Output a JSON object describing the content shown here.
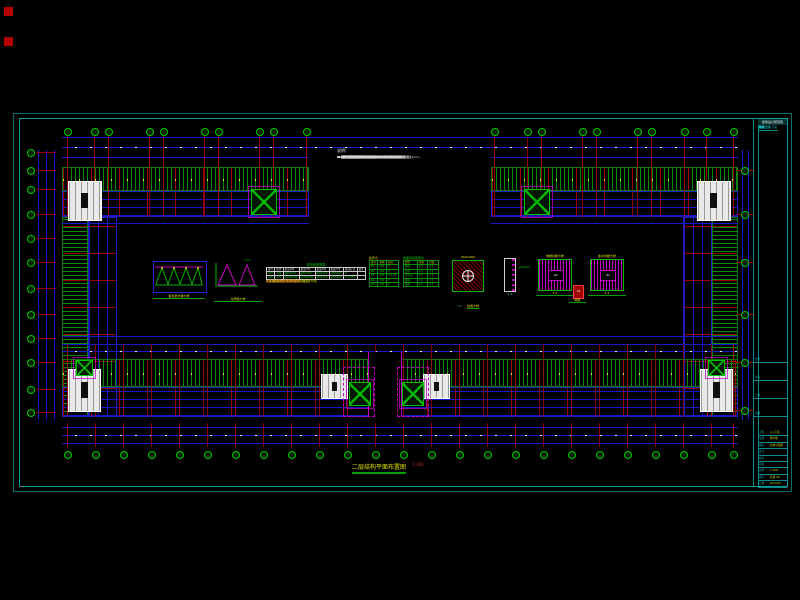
{
  "colors": {
    "bg": "#000000",
    "frame": "#0e9c9c",
    "green": "#00c000",
    "blue": "#1717cf",
    "red": "#b40000",
    "magenta": "#c400c4",
    "yellow": "#e0e000",
    "white": "#e9e9e9",
    "cyan_text": "#18b8b8"
  },
  "notes": {
    "title": "说明:",
    "lines": [
      "1. 本图尺寸除标高以米计外，其余均以毫米计。",
      "2. 本层结构标高为 3.570m。",
      "3. 本层现浇板混凝土强度等级为C30，钢筋保护层厚度15mm。",
      "4. 图中未注明板厚均为100mm。",
      "5. 未注明板底钢筋均为φ8@200，双向布置。",
      "6. 未注明板面负筋均为φ8@200，长度详见平面图。",
      "7. 板内分布筋均为φ6@250。",
      "8. 双向板底筋短跨方向在下，长跨方向在上。",
      "9. 卫生间、阳台板面标高降低50mm，详见建筑图。",
      "10. 板上预留洞口位置及尺寸详见建筑及设备图。",
      "11. 洞口直径或宽度不大于300mm时，钢筋绕洞口通过。",
      "12. 洞口大于300mm时，洞边附加钢筋详见大样图。",
      "13. 板角附加放射筋详见大样。",
      "14. 悬挑板阳角附加放射筋7φ10。",
      "15. 梁配筋详见梁平法施工图。",
      "16. 柱配筋详见柱平法施工图。",
      "17. 楼梯详见楼梯详图。",
      "18. 电梯井道详见大样图。",
      "19. 施工时应与建筑及设备各专业图纸密切配合。",
      "20. 未尽事宜详见结构设计总说明。"
    ]
  },
  "details": {
    "truss_label": "板负筋支撑大样",
    "tri_label": "马凳筋大样",
    "tri_dim": "h-30",
    "rebar_table": {
      "title": "现浇板配筋表",
      "headers": [
        "编号",
        "板厚",
        "板底X向",
        "板底Y向",
        "板面X向",
        "板面Y向",
        "板面标高",
        "备注"
      ],
      "rows": [
        [
          "LB1",
          "100",
          "φ8@200",
          "φ8@200",
          "φ8@200",
          "φ8@200",
          "H",
          ""
        ],
        [
          "LB2",
          "120",
          "φ10@200",
          "φ10@200",
          "φ8@200",
          "φ8@200",
          "H-0.050",
          ""
        ]
      ],
      "notes": [
        "注:1.板配筋图中未注明者详见本表。",
        "2.板底钢筋伸入支座长度≥5d且至梁中线。",
        "3.板面负筋长度自梁边起算。",
        "4.施工时严禁踩踏板面负筋。"
      ]
    },
    "green_table_1": {
      "title": "板厚表",
      "headers": [
        "编号",
        "板厚",
        "标高"
      ],
      "rows": [
        [
          "B1",
          "100",
          "H"
        ],
        [
          "B2",
          "110",
          "H"
        ],
        [
          "B3",
          "120",
          "H-0.05"
        ],
        [
          "B4",
          "130",
          "H"
        ],
        [
          "B5",
          "150",
          "H"
        ]
      ]
    },
    "green_table_2": {
      "title": "楼面荷载取值表",
      "headers": [
        "部位",
        "恒载",
        "活载"
      ],
      "rows": [
        [
          "楼面",
          "4.0",
          "2.0"
        ],
        [
          "走廊",
          "4.0",
          "2.5"
        ],
        [
          "卫生间",
          "4.5",
          "2.5"
        ],
        [
          "楼梯",
          "7.0",
          "3.5"
        ],
        [
          "屋面",
          "5.0",
          "0.5"
        ]
      ]
    },
    "cap_dim": "900×900",
    "cap_label_num": "1-1",
    "cap_label": "柱帽大样",
    "sect_text": "φ8@200",
    "sect_label": "2-2",
    "shaft1_title": "电梯井壁大样",
    "shaft1_mark": "Q1",
    "shaft1_label": "3-3",
    "shaft2_title": "集水坑壁大样",
    "shaft2_mark": "Q2",
    "shaft2_label": "4-4",
    "gz_mark": "GZ",
    "gz_label": "暗柱"
  },
  "plan": {
    "title": "二层结构平面布置图",
    "scale": "1:100"
  },
  "axes": {
    "top_left_x": [
      67,
      94,
      108,
      149,
      163,
      204,
      218,
      259,
      273,
      306
    ],
    "top_right_x": [
      494,
      527,
      541,
      582,
      596,
      637,
      651,
      684,
      706,
      733
    ],
    "bottom_x": [
      67,
      95,
      123,
      151,
      179,
      207,
      235,
      263,
      291,
      319,
      347,
      375,
      403,
      431,
      459,
      487,
      515,
      543,
      571,
      599,
      627,
      655,
      683,
      711,
      733
    ],
    "left_y": [
      152,
      170,
      189,
      214,
      238,
      262,
      288,
      314,
      338,
      362,
      389,
      412
    ],
    "right_y": [
      170,
      214,
      262,
      314,
      362,
      410
    ]
  },
  "titleblock": {
    "header": "建筑设计研究院",
    "rows": [
      "修改  日期  签名",
      "审定",
      "审核",
      "专业负责",
      "校对",
      "设计",
      "制图",
      "工种",
      "日期"
    ],
    "section_labels": [
      "会签",
      "专业",
      "日期",
      "出图"
    ],
    "kv_rows": [
      [
        "工程",
        "××工程"
      ],
      [
        "项目",
        "教学楼"
      ],
      [
        "图名",
        "结构平面图"
      ],
      [
        "设计",
        ""
      ],
      [
        "校对",
        ""
      ],
      [
        "审核",
        ""
      ],
      [
        "比例",
        "1:100"
      ],
      [
        "图号",
        "结施-08"
      ],
      [
        "日期",
        "2013.06"
      ]
    ]
  }
}
